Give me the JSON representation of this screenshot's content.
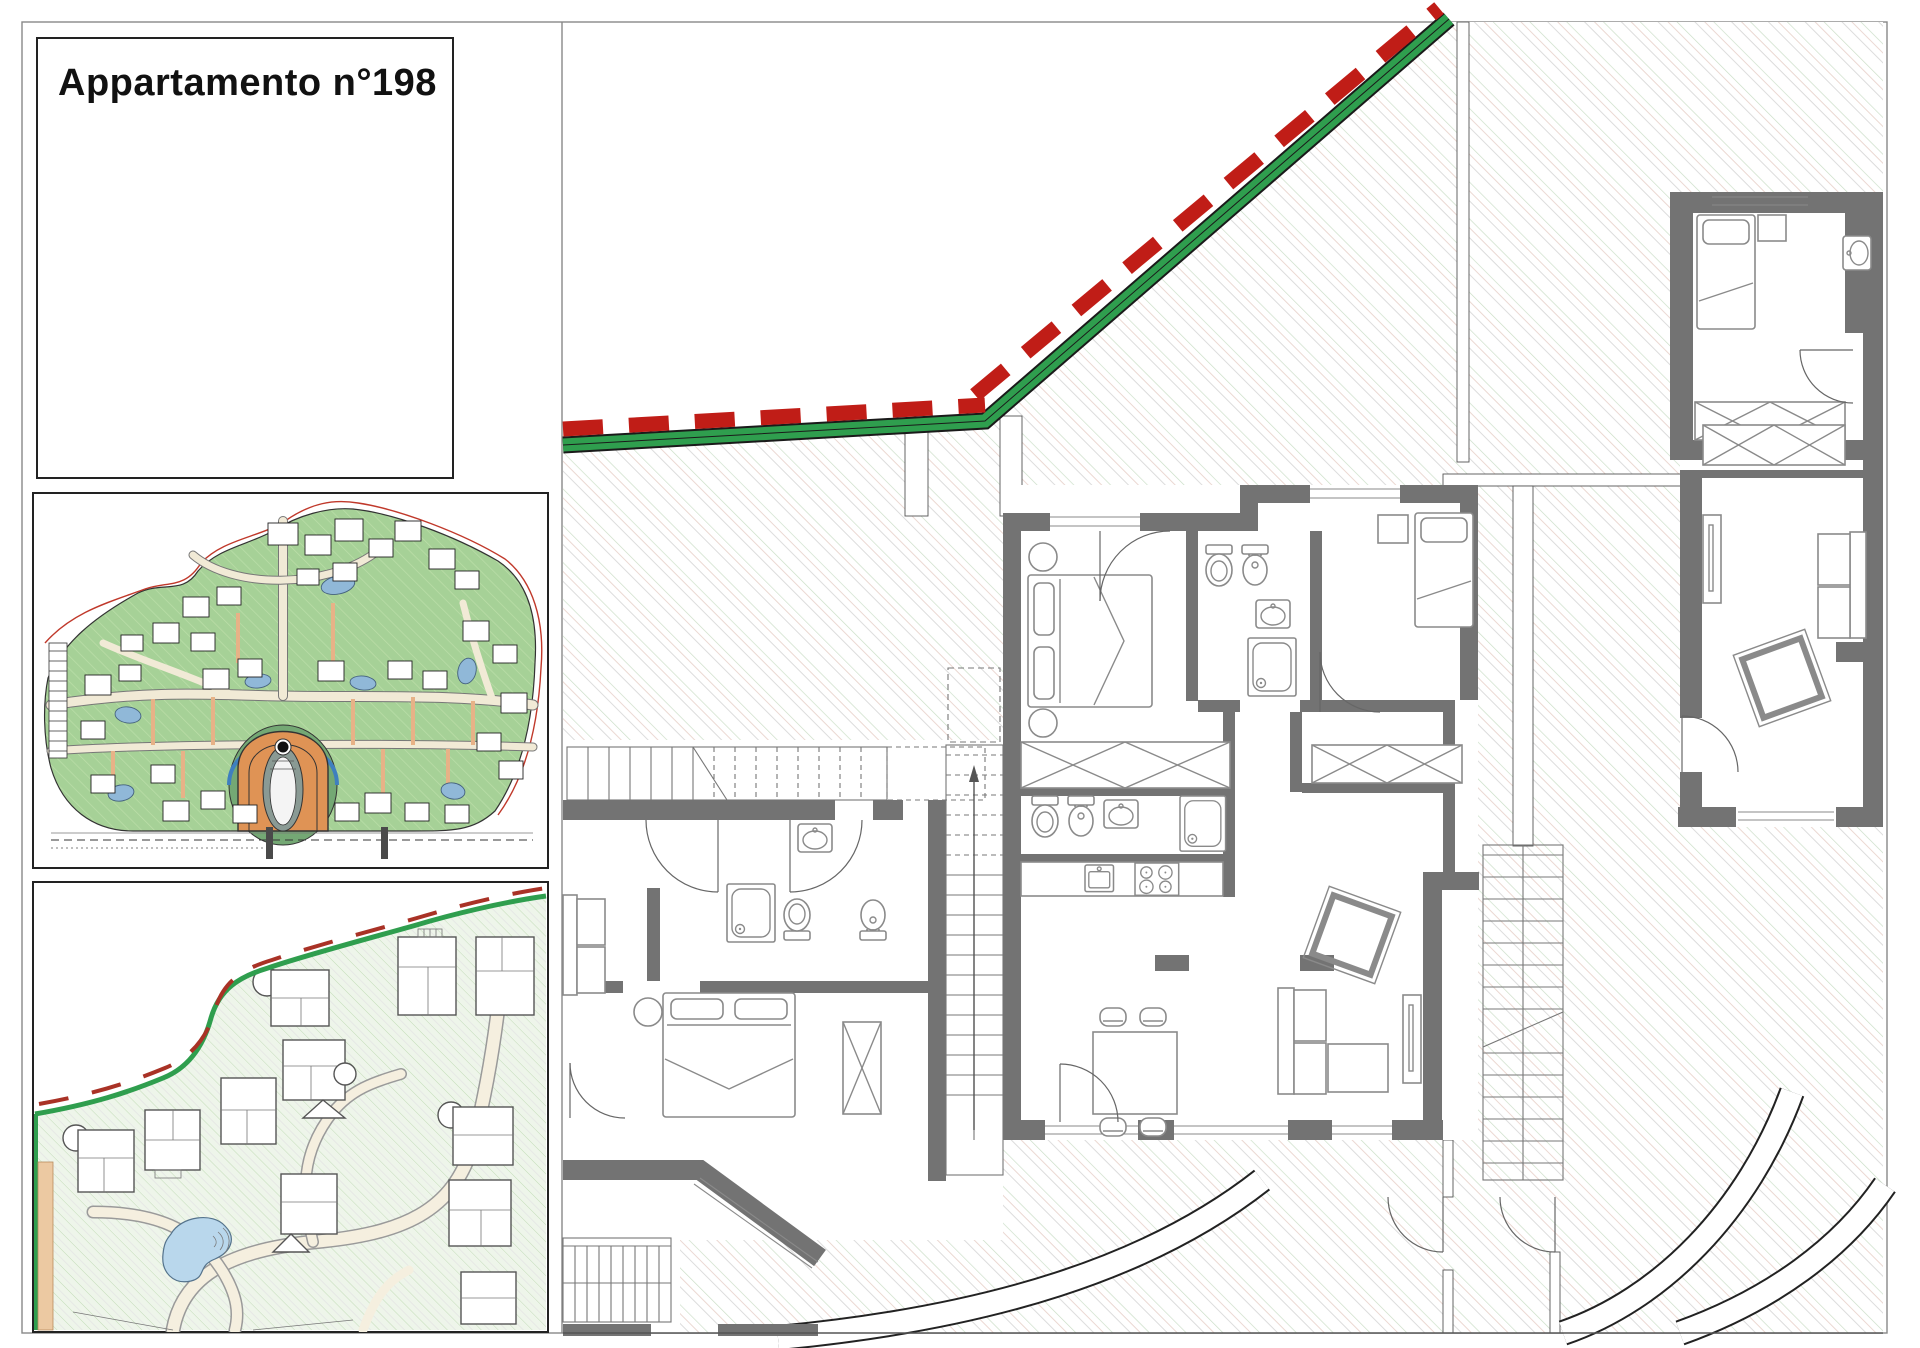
{
  "sheet": {
    "title": "Appartamento n°198",
    "type_label": "architectural floor plan sheet"
  },
  "panels": {
    "title_panel": {
      "label": "Appartamento n°198"
    },
    "masterplan_panel": {
      "name": "masterplan overview map"
    },
    "siteplan_panel": {
      "name": "site detail plan"
    },
    "main_plan": {
      "name": "apartment floor plan n.198"
    }
  },
  "colors": {
    "boundary_green": "#2f9e4e",
    "boundary_red": "#c01d17",
    "wall_gray": "#737373",
    "terrain_green": "#a6d197",
    "terrain_dark_green": "#74a874",
    "road_cream": "#f1ead6",
    "path_salmon": "#e7b287",
    "water_blue": "#90b8d8",
    "pool_blue": "#b9d7ec",
    "hatch_green": "#c9ddc5",
    "hatch_gray": "#dcdcdc",
    "hatch_pink": "#e7cfc7",
    "arch_orange": "#df9355"
  }
}
